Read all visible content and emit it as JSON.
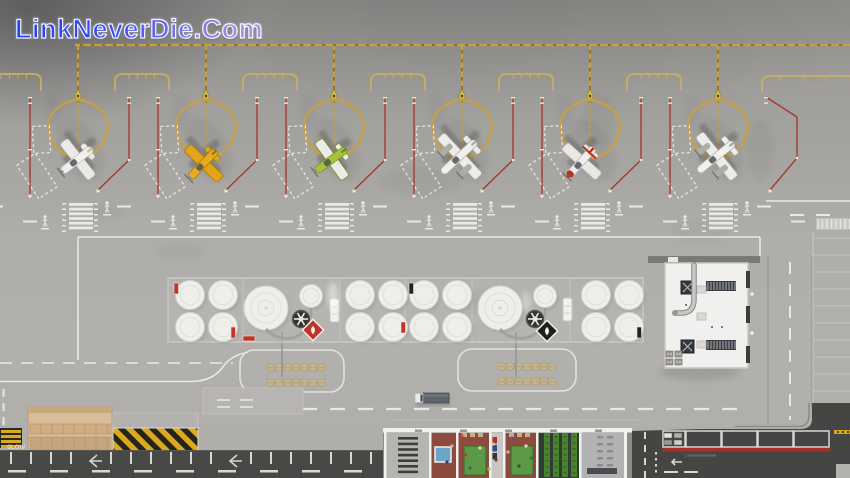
{
  "watermark": {
    "text": "LinkNeverDie.Com"
  },
  "labels": {
    "slow_marking": "SLOW"
  },
  "colors": {
    "taxiway_yellow": "#c79f44",
    "taxiway_dark": "#7e5f16",
    "tiedown_red": "#a63a32",
    "marking_white": "#e9e8e5",
    "hazard_yellow": "#dca81e",
    "warning_red": "#c13527",
    "warning_black": "#201f1d",
    "pool_blue": "#6aa6c8",
    "table_green": "#5d9a47",
    "floor_red": "#8e4a3c",
    "apron_gray": "#b0aeaa",
    "asphalt_dark": "#454543"
  },
  "ga_stands": {
    "count": 6,
    "centers_x": [
      78,
      206,
      334,
      462,
      590,
      718
    ],
    "taxiway_y": 45,
    "bracket_xs": [
      14,
      142,
      270,
      398,
      526,
      654
    ],
    "walkway_mid_xs": [
      14,
      142,
      270,
      398,
      526,
      654,
      782
    ]
  },
  "aircraft": [
    {
      "name": "white-single-prop",
      "type": "single",
      "x": 77,
      "y": 160,
      "rot": -128,
      "body": "#f1f0ed",
      "wing": "#ebeae6",
      "detail": "#c0beba"
    },
    {
      "name": "yellow-single-prop",
      "type": "single",
      "x": 203,
      "y": 164,
      "rot": -136,
      "body": "#e8ac1e",
      "wing": "#e2a418",
      "detail": "#9c7608"
    },
    {
      "name": "green-single-prop",
      "type": "single",
      "x": 331,
      "y": 160,
      "rot": -126,
      "body": "#a8c23c",
      "wing": "#ecebe7",
      "detail": "#6f8c1a"
    },
    {
      "name": "white-twin-prop",
      "type": "twin",
      "x": 459,
      "y": 157,
      "rot": -133,
      "body": "#f1f0ed",
      "wing": "#edece8",
      "detail": "#aeaca8"
    },
    {
      "name": "red-trim-single-prop",
      "type": "single",
      "x": 581,
      "y": 162,
      "rot": -138,
      "body": "#f0efec",
      "wing": "#eae8e4",
      "detail": "#b8b6b2",
      "trim": "#b83228"
    },
    {
      "name": "white-twin-prop",
      "type": "twin",
      "x": 716,
      "y": 157,
      "rot": -129,
      "body": "#f1f0ed",
      "wing": "#edece8",
      "detail": "#aeaca8"
    }
  ],
  "fuel_farm": {
    "bounds": [
      168,
      278,
      475,
      64
    ],
    "divider_xs": [
      243,
      340,
      405,
      472,
      570
    ],
    "small_tanks_cx": [
      190,
      223,
      360,
      393,
      424,
      457,
      596,
      629
    ],
    "small_tanks_cy": [
      295,
      327
    ],
    "big_tanks": [
      {
        "x": 266,
        "y": 308
      },
      {
        "x": 500,
        "y": 308
      }
    ],
    "aux_tanks": [
      {
        "x": 311,
        "y": 296
      },
      {
        "x": 545,
        "y": 296
      }
    ],
    "pumps": [
      {
        "x": 330,
        "y": 299
      },
      {
        "x": 563,
        "y": 298
      }
    ],
    "valves": [
      {
        "x": 301,
        "y": 319
      },
      {
        "x": 535,
        "y": 319
      }
    ],
    "warning_signs": [
      {
        "x": 313,
        "y": 330,
        "glyph": "flame",
        "bg": "#c13527"
      },
      {
        "x": 547,
        "y": 331,
        "glyph": "drop",
        "bg": "#201f1d"
      }
    ],
    "tags": [
      [
        174,
        283,
        "r"
      ],
      [
        231,
        327,
        "r"
      ],
      [
        243,
        336,
        "rh"
      ],
      [
        409,
        283,
        "k"
      ],
      [
        401,
        322,
        "r"
      ],
      [
        637,
        327,
        "k"
      ]
    ],
    "hydrant_lines_x": [
      282,
      516
    ]
  },
  "staging_areas": [
    {
      "x": 240,
      "y": 350,
      "w": 104,
      "h": 42,
      "pallet_x0": 267
    },
    {
      "x": 458,
      "y": 349,
      "w": 118,
      "h": 42,
      "pallet_x0": 498
    }
  ],
  "truck": {
    "x": 415,
    "y": 393
  },
  "terminal": {
    "x": 383,
    "y": 428,
    "w": 249,
    "rooms": [
      {
        "w": 45,
        "floor": "#b6b4b0",
        "feat": "shelves"
      },
      {
        "w": 27,
        "floor": "#8e4a3c",
        "feat": "pool"
      },
      {
        "w": 33,
        "floor": "#8e4a3c",
        "feat": "table"
      },
      {
        "w": 14,
        "floor": "#c9c7c3",
        "feat": "vend"
      },
      {
        "w": 33,
        "floor": "#8e4a3c",
        "feat": "table"
      },
      {
        "w": 43,
        "floor": "#2e3c32",
        "feat": "garden"
      },
      {
        "w": 44,
        "floor": "#b2b2b4",
        "feat": "office"
      }
    ],
    "people": [
      [
        452,
        446,
        "#c8b894"
      ],
      [
        447,
        462,
        "#2e4058"
      ],
      [
        466,
        455,
        "#b04038"
      ],
      [
        480,
        448,
        "#e0d6c4"
      ],
      [
        470,
        468,
        "#3c5a78"
      ],
      [
        493,
        444,
        "#d8c8a8"
      ],
      [
        496,
        460,
        "#7a3848"
      ],
      [
        508,
        452,
        "#c8b894"
      ],
      [
        519,
        466,
        "#2e4e38"
      ],
      [
        526,
        446,
        "#e8dcc8"
      ],
      [
        462,
        436,
        "#d05048"
      ],
      [
        512,
        438,
        "#3a6a9a"
      ],
      [
        489,
        469,
        "#c0a878"
      ],
      [
        531,
        458,
        "#506a3a"
      ]
    ]
  },
  "depot": {
    "bays": [
      [
        663,
        22
      ],
      [
        686,
        35
      ],
      [
        722,
        35
      ],
      [
        758,
        35
      ],
      [
        794,
        35
      ]
    ],
    "red_stripe": [
      663,
      448,
      167
    ]
  },
  "warehouse": {
    "x": 665,
    "y": 263,
    "w": 83,
    "h": 105
  }
}
